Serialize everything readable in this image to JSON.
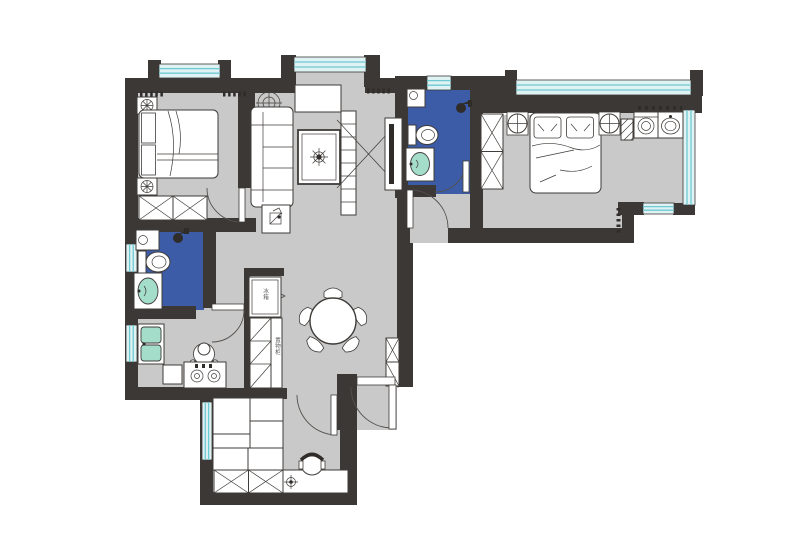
{
  "figure_type": "apartment-floor-plan",
  "colors": {
    "wall": "#3b3836",
    "floor": "#c9c9c9",
    "bath": "#3d5ca7",
    "stroke": "#3f3c39",
    "green": "#a5ddcb",
    "winfill": "#dff2f4",
    "winln": "#6fc9d2",
    "paper": "#ffffff"
  },
  "labels": {
    "fridge": "冰箱",
    "cabinet": "置物柜"
  }
}
